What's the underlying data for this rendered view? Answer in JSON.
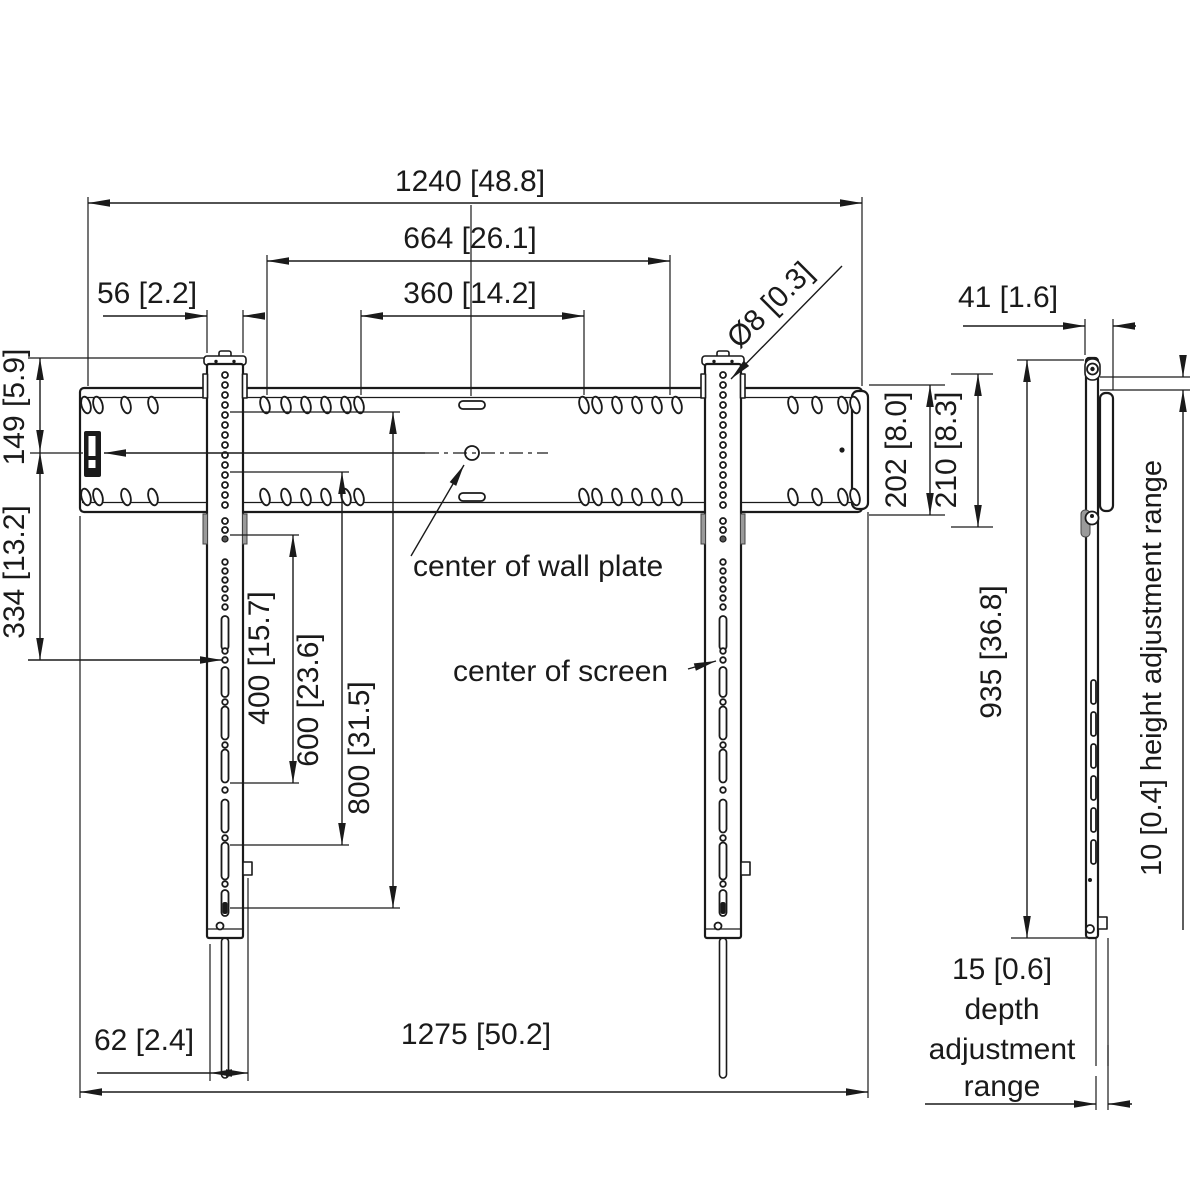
{
  "front_view": {
    "dim_width_top": "1240 [48.8]",
    "dim_width_inner": "664 [26.1]",
    "dim_hole_spacing": "360 [14.2]",
    "dim_rail_width": "56 [2.2]",
    "dim_hole_diameter": "Ø8 [0.3]",
    "dim_top_to_center": "149 [5.9]",
    "dim_center_offset": "334 [13.2]",
    "dim_plate_height": "202 [8.0]",
    "dim_plate_height_total": "210 [8.3]",
    "dim_vesa_400": "400 [15.7]",
    "dim_vesa_600": "600 [23.6]",
    "dim_vesa_800": "800 [31.5]",
    "dim_strap_width": "62 [2.4]",
    "dim_width_total": "1275 [50.2]",
    "label_center_wall_plate": "center of wall plate",
    "label_center_screen": "center of screen"
  },
  "side_view": {
    "dim_depth": "41 [1.6]",
    "dim_height": "935 [36.8]",
    "label_height_adjustment": "10 [0.4] height adjustment range",
    "depth_adjustment": {
      "line1": "15 [0.6]",
      "line2": "depth",
      "line3": "adjustment",
      "line4": "range"
    }
  },
  "colors": {
    "line": "#1a1a1a",
    "background": "#ffffff",
    "shade": "#9a9a9a"
  }
}
